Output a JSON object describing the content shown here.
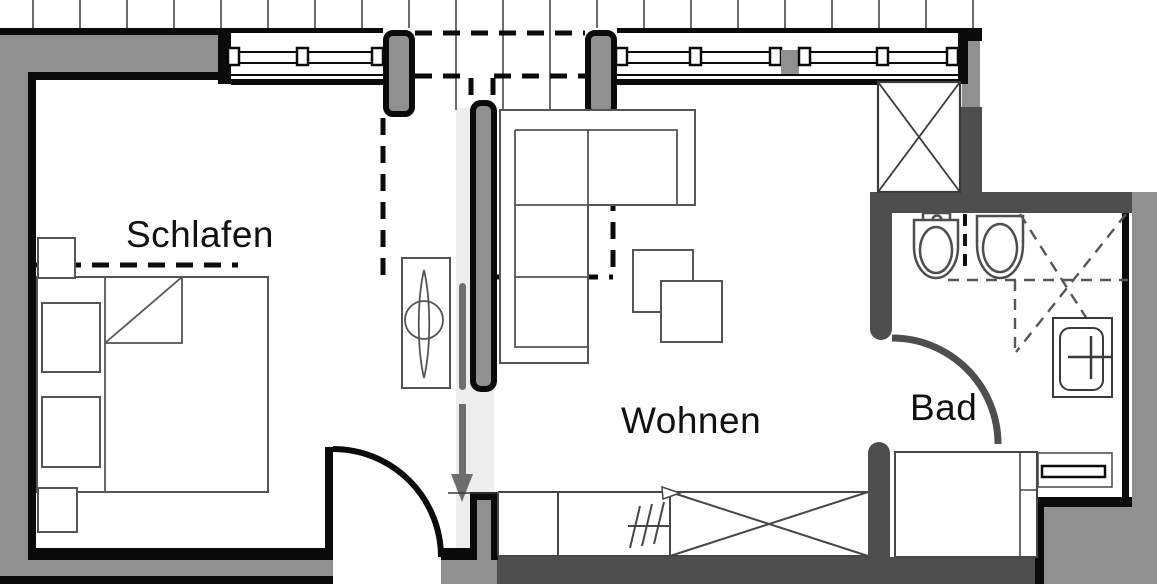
{
  "plan": {
    "type": "apartment-floor-plan",
    "rooms": {
      "bedroom": {
        "label": "Schlafen"
      },
      "living": {
        "label": "Wohnen"
      },
      "bath": {
        "label": "Bad"
      }
    },
    "symbols": [
      "bed",
      "nightstand",
      "stool",
      "tv-cabinet",
      "sliding-door-panel",
      "entrance-arrow",
      "corner-sofa",
      "coffee-table",
      "sideboard",
      "dishwasher-cabinet",
      "wardrobe-x-cabinet",
      "shaft-x-box",
      "bidet",
      "toilet",
      "shower",
      "washbasin",
      "bathtub",
      "towel-shelf",
      "window",
      "door-swing",
      "roof-slope-dashed-line",
      "terrace-planks"
    ]
  },
  "colors": {
    "background": "#ffffff",
    "wall_gray": "#909090",
    "wall_dark": "#4e4e4e",
    "wall_black": "#0b0b0b",
    "furniture_outline": "#555555",
    "fixture_outline": "#4e4e4e",
    "thin_line": "#3a3a3a",
    "floor_highlight": "#ededed",
    "arrow_gray": "#6e6e6e",
    "label_color": "#111111"
  }
}
